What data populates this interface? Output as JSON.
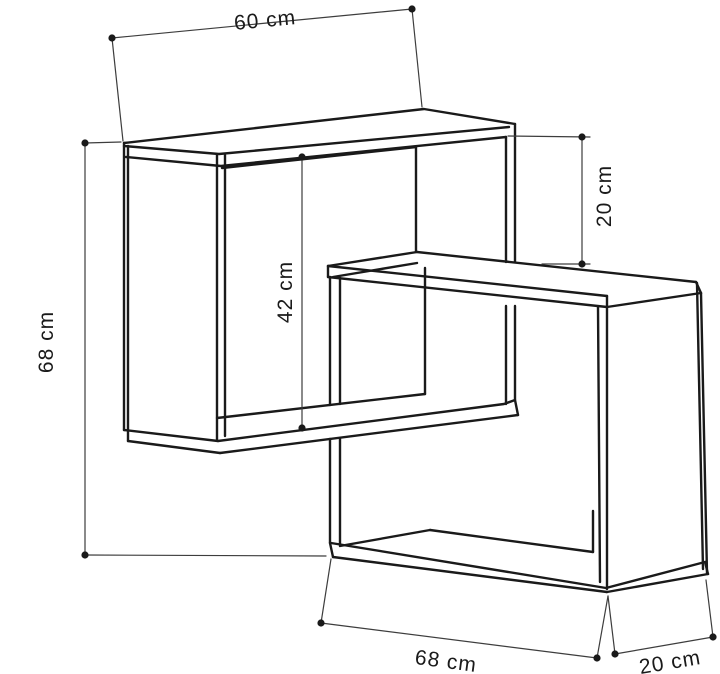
{
  "diagram": {
    "subject": "corner-wall-shelf-dimension-drawing",
    "background_color": "#ffffff",
    "structure_line_color": "#1a1a1a",
    "dimension_line_color": "#3d3d3d",
    "labels": {
      "top_width": "60 cm",
      "right_offset_height": "20 cm",
      "inner_height": "42 cm",
      "left_total_height": "68 cm",
      "bottom_width": "68 cm",
      "bottom_depth": "20 cm"
    }
  }
}
